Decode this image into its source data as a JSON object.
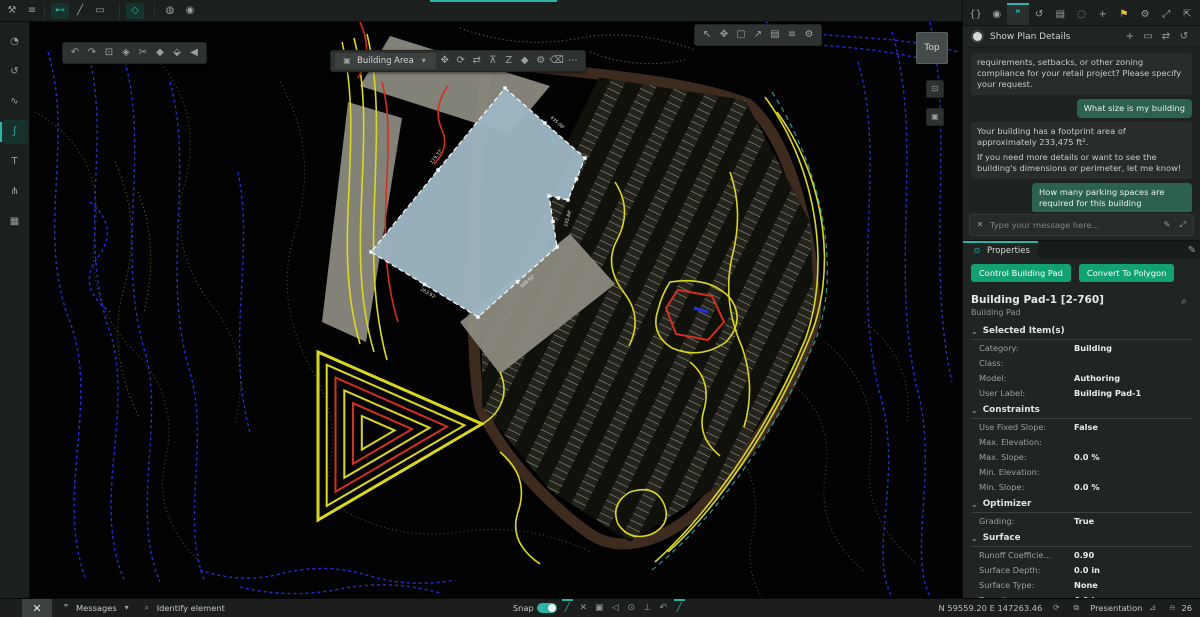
{
  "colors": {
    "accent": "#2bb3a3",
    "button_green": "#12a173",
    "user_bubble": "#2c6152",
    "warning_yellow": "#e8c32a"
  },
  "icons": {
    "wrench": "⚒",
    "menu": "≡",
    "measure": "⊷",
    "line": "╱",
    "rect": "▭",
    "shape": "◇",
    "circle-a": "◍",
    "circle-b": "◉",
    "gauge": "◔",
    "history": "↺",
    "wave": "∿",
    "grade": "∫",
    "text": "T",
    "share": "⋔",
    "toolbox": "▦",
    "select": "↖",
    "ruler": "▱",
    "nodes": "⋈",
    "pencil": "✎",
    "rect-add": "⊞",
    "copy": "⧉",
    "merge": "M",
    "stamp": "♟",
    "gear": "⚙",
    "layers": "⊡",
    "terrain": "△",
    "warn": "▲",
    "undo": "↶",
    "redo": "↷",
    "clipboard": "⊡",
    "paint": "◈",
    "cut": "✂",
    "diamond": "◆",
    "prism": "⬙",
    "back": "◀",
    "move": "✥",
    "rotate": "⟳",
    "swap": "⇄",
    "elevate": "⊼",
    "zorder": "Z",
    "hex": "◆",
    "erase": "⌫",
    "more": "⋯",
    "cursor": "↖",
    "pan": "✥",
    "frame": "▢",
    "export": "↗",
    "card": "▤",
    "rows": "≡",
    "settings": "⚙",
    "code": "{}",
    "assistant": "◉",
    "chat": "❞",
    "doc": "▤",
    "record": "◌",
    "add": "+",
    "flag": "⚑",
    "expand": "⤢",
    "dock": "⇱",
    "plus": "+",
    "window": "▭",
    "search": "⌕",
    "send": "➢",
    "clear": "✕",
    "slash": "╱",
    "grid": "▣",
    "tri": "◁",
    "dot": "⊙",
    "perp": "⊥",
    "undo2": "↶",
    "messages": "❞",
    "identify": "⌕",
    "orbit": "⟳",
    "screen": "⧉",
    "pyramid": "⊿",
    "bell": "⍾",
    "caret": "▾",
    "chev": "⌄"
  },
  "top_bar": {
    "tools": [
      "measure",
      "line",
      "rect"
    ],
    "active_tool": "shape",
    "extras": [
      "circle-a",
      "circle-b"
    ]
  },
  "sidebar": {
    "items": [
      "gauge",
      "history",
      "wave",
      "grade",
      "text",
      "share",
      "toolbox"
    ],
    "selected_index": 3
  },
  "palette": {
    "items": [
      "select",
      "ruler",
      "line",
      "nodes",
      "pencil",
      "rect-add",
      "copy",
      "merge",
      "stamp",
      "gear",
      "layers",
      "terrain"
    ],
    "active_index": 0,
    "badge_index": 10
  },
  "canvas": {
    "history_toolbar": [
      "undo",
      "redo",
      "clipboard",
      "paint",
      "cut",
      "diamond",
      "prism",
      "back"
    ],
    "selection_toolbar": {
      "label": "Building Area",
      "icons": [
        "move",
        "rotate",
        "swap",
        "elevate",
        "zorder",
        "hex",
        "gear",
        "erase",
        "more"
      ]
    },
    "view_toolbar": [
      "cursor",
      "pan",
      "frame",
      "export",
      "card",
      "rows",
      "settings"
    ],
    "view_cube_label": "Top",
    "mini_buttons": [
      "layers",
      "grid"
    ],
    "dimensions": [
      {
        "text": "435.08'",
        "x": 520,
        "y": 96,
        "r": 41
      },
      {
        "text": "155.84'",
        "x": 537,
        "y": 205,
        "r": -75
      },
      {
        "text": "509.62'",
        "x": 492,
        "y": 266,
        "r": -41
      },
      {
        "text": "263.92'",
        "x": 390,
        "y": 268,
        "r": 31
      },
      {
        "text": "119.37'",
        "x": 402,
        "y": 142,
        "r": -52
      }
    ]
  },
  "right_panel": {
    "tabs": [
      "code",
      "assistant",
      "chat",
      "history",
      "doc",
      "record",
      "add",
      "flag",
      "gear"
    ],
    "active_tab_index": 2,
    "flag_index": 7,
    "window_icons": [
      "expand",
      "dock"
    ],
    "chat": {
      "title": "Show Plan Details",
      "header_icons": [
        "plus",
        "window",
        "swap",
        "history"
      ],
      "messages": [
        {
          "role": "assistant",
          "text": "requirements, setbacks, or other zoning compliance for your retail project? Please specify your request."
        },
        {
          "role": "user",
          "text": "What size is my building"
        },
        {
          "role": "assistant",
          "text": "Your building has a footprint area of approximately 233,475 ft².\nIf you need more details or want to see the building's dimensions or perimeter, let me know!"
        },
        {
          "role": "user",
          "text": "How many parking spaces are required for this building"
        },
        {
          "role": "status",
          "text": "Searching documents..."
        }
      ],
      "input_placeholder": "Type your message here..."
    },
    "properties": {
      "tab_label": "Properties",
      "buttons": [
        "Control Building Pad",
        "Convert To Polygon"
      ],
      "title": "Building Pad-1 [2-760]",
      "subtitle": "Building Pad",
      "sections": [
        {
          "label": "Selected Item(s)",
          "rows": [
            [
              "Category:",
              "Building"
            ],
            [
              "Class:",
              ""
            ],
            [
              "Model:",
              "Authoring"
            ],
            [
              "User Label:",
              "Building Pad-1"
            ]
          ]
        },
        {
          "label": "Constraints",
          "rows": [
            [
              "Use Fixed Slope:",
              "False"
            ],
            [
              "Max. Elevation:",
              ""
            ],
            [
              "Max. Slope:",
              "0.0 %"
            ],
            [
              "Min. Elevation:",
              ""
            ],
            [
              "Min. Slope:",
              "0.0 %"
            ]
          ]
        },
        {
          "label": "Optimizer",
          "rows": [
            [
              "Grading:",
              "True"
            ]
          ]
        },
        {
          "label": "Surface",
          "rows": [
            [
              "Runoff Coefficie...",
              "0.90"
            ],
            [
              "Surface Depth:",
              "0.0 in"
            ],
            [
              "Surface Type:",
              "None"
            ],
            [
              "Topsoil:",
              "6.0 in"
            ]
          ]
        }
      ]
    }
  },
  "status_bar": {
    "logo": "✕",
    "messages_label": "Messages",
    "identify_label": "Identify element",
    "snap_label": "Snap",
    "snap_icons": [
      {
        "id": "slash",
        "active": true
      },
      {
        "id": "clear",
        "active": false
      },
      {
        "id": "grid",
        "active": false
      },
      {
        "id": "tri",
        "active": false
      },
      {
        "id": "dot",
        "active": false
      },
      {
        "id": "perp",
        "active": false
      },
      {
        "id": "undo2",
        "active": false
      },
      {
        "id": "slash",
        "active": true
      }
    ],
    "coordinates": "N 59559.20   E 147263.46",
    "presentation_label": "Presentation",
    "notification_count": "26"
  }
}
